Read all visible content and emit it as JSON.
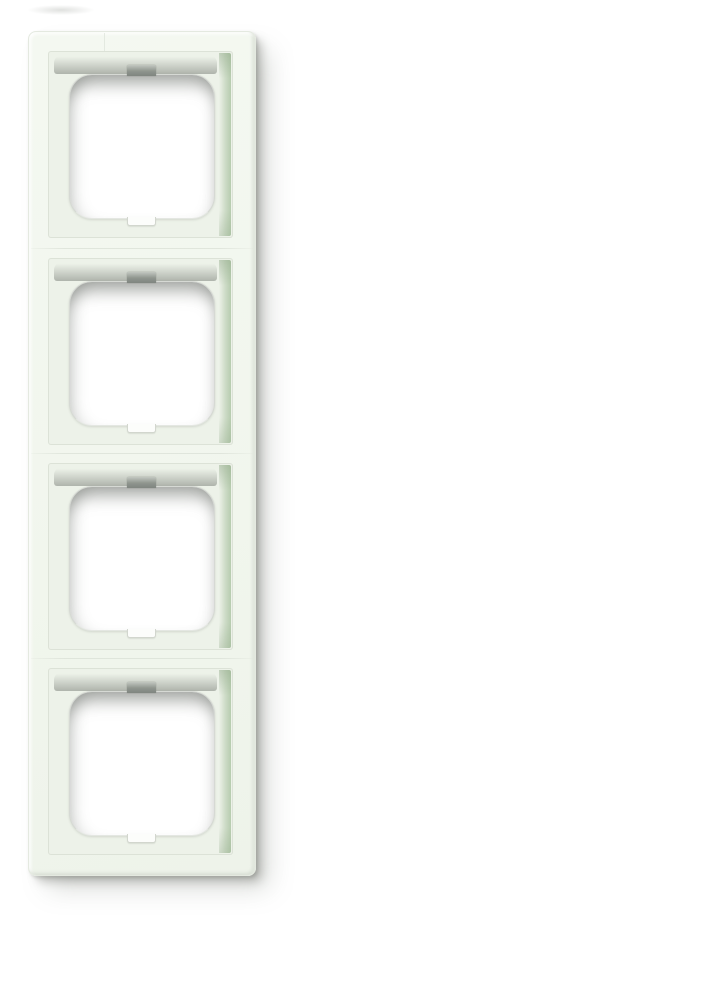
{
  "scene": {
    "type": "product-photo",
    "subject": "four-gang wall switch cover frame, portrait orientation, photographed on white",
    "gang_count": 4,
    "colors": {
      "background": "#ffffff",
      "surface": "#f4f8f1",
      "edge_line": "#e4e9e0",
      "recess": "#edf2e9",
      "wall_green": "#b6cbae",
      "band_gray": "#a8ada5",
      "hole_fill": "#ffffff",
      "hole_edge": "#a5aaa0",
      "notch_gray": "#8f958e",
      "notch_bottom_fill": "#fcfdfb",
      "seam": "#d6dcd2",
      "drop_shadow": "#8d908a"
    },
    "gangs": [
      {
        "id": 1,
        "has_top_notch": true,
        "has_bottom_notch": true
      },
      {
        "id": 2,
        "has_top_notch": true,
        "has_bottom_notch": true
      },
      {
        "id": 3,
        "has_top_notch": true,
        "has_bottom_notch": true
      },
      {
        "id": 4,
        "has_top_notch": true,
        "has_bottom_notch": true
      }
    ]
  }
}
